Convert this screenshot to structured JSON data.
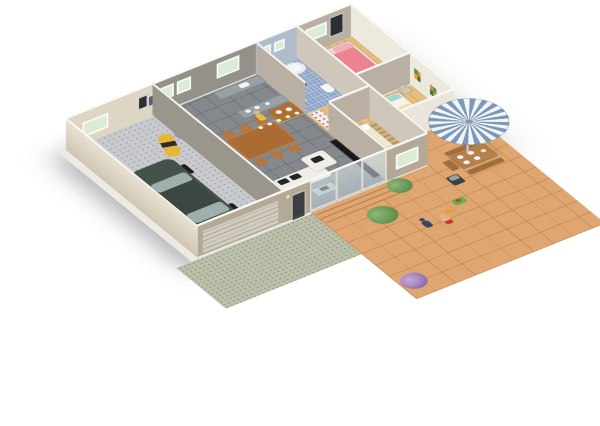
{
  "scene": {
    "type": "3d-isometric-floor-plan",
    "background": "#ffffff",
    "description": "Aerial 3D floor plan of a three-bedroom house with attached garage and large tiled patio, rendered on a white background with no text"
  },
  "palette": {
    "wall_outer": "#b4a897",
    "wall_inner": "#94908a",
    "wall_cream": "#ddd6c5",
    "wall_taupe": "#b9b0a3",
    "wall_top": "#faf8f3",
    "wall_right": "#eee9df",
    "wall_bath": "#aebdc9",
    "garage_floor": "#c8cacd",
    "living_floor": "#85898d",
    "wood_floor": "#e6bf7f",
    "bath_floor": "#8ba3c7",
    "patio_tile": "#dfa671",
    "grass": "#bcc0aa",
    "car_body": "#45514b",
    "car_roof": "#3c4742",
    "car_glass": "#9fb0ac",
    "scooter": "#e6b63c",
    "box": "#c7a269",
    "dining_wood": "#aa6c33",
    "chair_wood": "#b5773f",
    "sofa_white": "#f0eee7",
    "cushion_dark": "#23252a",
    "glass_table": "#b3bec0",
    "tv_black": "#17181b",
    "shelf_red": "#d5374f",
    "shelf_wood": "#c98a4b",
    "counter_gray": "#9aa1a5",
    "tub_white": "#f4f7f8",
    "bed_master_pink": "#ec8391",
    "bed_master_fold": "#dd6e80",
    "pillow_pink": "#f3aebb",
    "bed2_cream": "#efe9d2",
    "bed2_fold": "#ddd5bd",
    "bed3_yellow": "#f2dc8f",
    "pillow_teal": "#9fd8cf",
    "umb_blue": "#7d97b8",
    "umb_white": "#f3f6f6",
    "plant_green": "#5f8f4c",
    "plant_purple": "#a888bf",
    "kid_skin": "#e8b48e",
    "kid_shorts": "#cf3434",
    "dog_dark": "#3a4663",
    "toy_green": "#5cb44e",
    "toy_orange": "#e0a23c",
    "window_glass": "#dcebd6",
    "frame_white": "#fcfcfa",
    "art_dark": "#2b2f35",
    "bbq_dark": "#3a3f44"
  },
  "rooms": [
    {
      "id": "garage",
      "floor": "speckled-concrete",
      "items": [
        "dark-green-car",
        "yellow-scooter",
        "moving-boxes",
        "back-window",
        "ribbed-garage-door"
      ]
    },
    {
      "id": "dining-living",
      "floor": "gray-tile",
      "items": [
        "wood-dining-table",
        "six-chairs",
        "purple-potted-plant",
        "white-sofa",
        "white-lounge-chair",
        "glass-coffee-table",
        "black-tv-wall-unit",
        "red-shelf-unit",
        "green-topiary",
        "candle-half-wall",
        "person-yellow",
        "sliding-glass-door"
      ]
    },
    {
      "id": "kitchen",
      "floor": "gray-tile",
      "items": [
        "back-counter-with-sink",
        "island-counter",
        "wood-kitchen-table",
        "window"
      ]
    },
    {
      "id": "bathroom",
      "floor": "blue-mosaic",
      "items": [
        "bathtub",
        "toilet",
        "pedestal-sink",
        "person-standing",
        "two-small-windows"
      ]
    },
    {
      "id": "master-bedroom",
      "floor": "wood",
      "items": [
        "pink-double-bed",
        "nightstand-lamp",
        "dark-wall-art",
        "window",
        "floor-fan"
      ]
    },
    {
      "id": "hallway",
      "floor": "wood",
      "items": [
        "shoe-closet",
        "wardrobe"
      ]
    },
    {
      "id": "bedroom-2",
      "floor": "wood",
      "items": [
        "cream-single-bed",
        "ladder-shelf",
        "potted-plant",
        "wardrobe-with-clothes",
        "front-window"
      ]
    },
    {
      "id": "bedroom-3",
      "floor": "wood",
      "items": [
        "yellow-single-bed-teal-pillows",
        "nightstand-lamp",
        "colorful-wall-art"
      ]
    },
    {
      "id": "patio",
      "floor": "terracotta-tile",
      "items": [
        "blue-white-striped-umbrella",
        "wood-table-with-plates",
        "two-benches",
        "stool",
        "barbecue",
        "two-green-bushes",
        "purple-bush",
        "child-figure",
        "dog",
        "green-toy-car",
        "small-toy",
        "entry-steps"
      ]
    },
    {
      "id": "yard",
      "floor": "grass",
      "items": []
    }
  ]
}
